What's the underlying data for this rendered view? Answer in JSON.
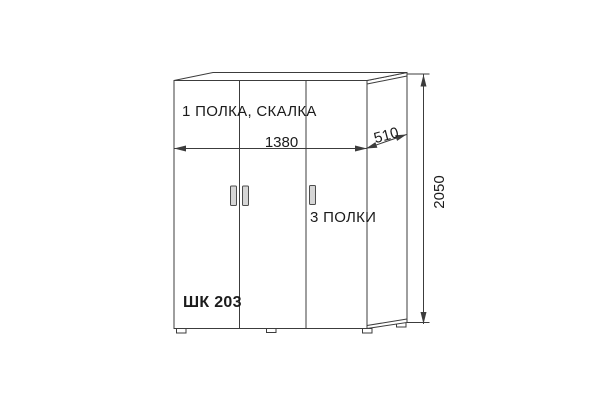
{
  "diagram": {
    "compartment_labels": {
      "top_section": "1 ПОЛКА, СКАЛКА",
      "right_section": "3 ПОЛКИ"
    },
    "model": "ШК 203",
    "dimensions": {
      "width": "1380",
      "depth": "510",
      "height": "2050"
    }
  },
  "colors": {
    "background": "#ffffff",
    "line": "#3c3c3c",
    "text": "#1b1b1b",
    "handle_fill": "#d6d6d6",
    "handle_stroke": "#4d4d4d"
  }
}
